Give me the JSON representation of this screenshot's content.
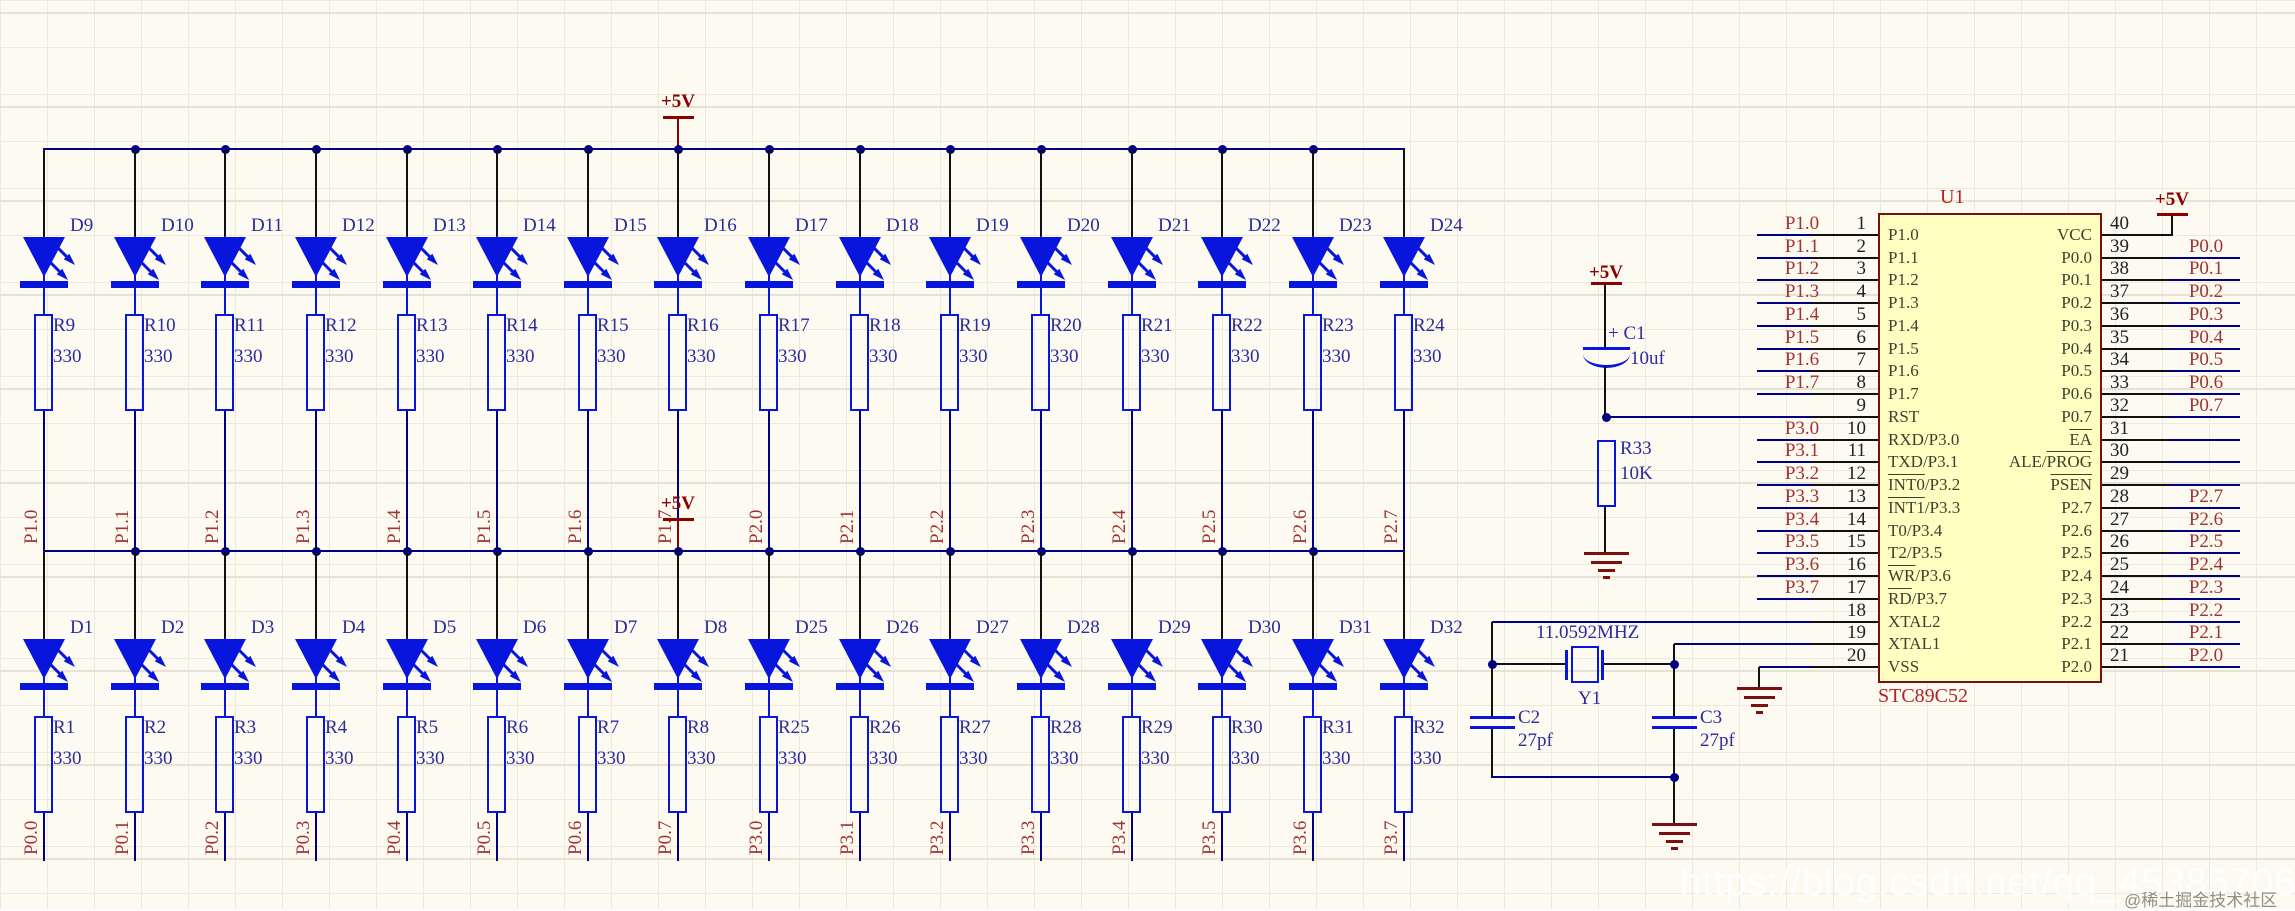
{
  "power": {
    "label": "+5V"
  },
  "colors": {
    "wire": "#000080",
    "symbol": "#0715dd",
    "net_label": "#a03333",
    "power": "#8b0000",
    "mcu_fill": "#ffffc2",
    "mcu_border": "#7a1010"
  },
  "top_row": {
    "leds": [
      "D9",
      "D10",
      "D11",
      "D12",
      "D13",
      "D14",
      "D15",
      "D16",
      "D17",
      "D18",
      "D19",
      "D20",
      "D21",
      "D22",
      "D23",
      "D24"
    ],
    "resistors": [
      "R9",
      "R10",
      "R11",
      "R12",
      "R13",
      "R14",
      "R15",
      "R16",
      "R17",
      "R18",
      "R19",
      "R20",
      "R21",
      "R22",
      "R23",
      "R24"
    ],
    "resistor_value": "330",
    "pins": [
      "P1.0",
      "P1.1",
      "P1.2",
      "P1.3",
      "P1.4",
      "P1.5",
      "P1.6",
      "P1.7",
      "P2.0",
      "P2.1",
      "P2.2",
      "P2.3",
      "P2.4",
      "P2.5",
      "P2.6",
      "P2.7"
    ]
  },
  "bottom_row": {
    "leds": [
      "D1",
      "D2",
      "D3",
      "D4",
      "D5",
      "D6",
      "D7",
      "D8",
      "D25",
      "D26",
      "D27",
      "D28",
      "D29",
      "D30",
      "D31",
      "D32"
    ],
    "resistors": [
      "R1",
      "R2",
      "R3",
      "R4",
      "R5",
      "R6",
      "R7",
      "R8",
      "R25",
      "R26",
      "R27",
      "R28",
      "R29",
      "R30",
      "R31",
      "R32"
    ],
    "resistor_value": "330",
    "pins": [
      "P0.0",
      "P0.1",
      "P0.2",
      "P0.3",
      "P0.4",
      "P0.5",
      "P0.6",
      "P0.7",
      "P3.0",
      "P3.1",
      "P3.2",
      "P3.3",
      "P3.4",
      "P3.5",
      "P3.6",
      "P3.7"
    ]
  },
  "reset_circuit": {
    "cap_label": "+ C1",
    "cap_value": "10uf",
    "res_ref": "R33",
    "res_value": "10K"
  },
  "crystal_circuit": {
    "freq": "11.0592MHZ",
    "ref": "Y1",
    "c2_ref": "C2",
    "c2_value": "27pf",
    "c3_ref": "C3",
    "c3_value": "27pf"
  },
  "mcu": {
    "ref": "U1",
    "part": "STC89C52",
    "left_pins": [
      {
        "num": "1",
        "label": "P1.0",
        "net": "P1.0"
      },
      {
        "num": "2",
        "label": "P1.1",
        "net": "P1.1"
      },
      {
        "num": "3",
        "label": "P1.2",
        "net": "P1.2"
      },
      {
        "num": "4",
        "label": "P1.3",
        "net": "P1.3"
      },
      {
        "num": "5",
        "label": "P1.4",
        "net": "P1.4"
      },
      {
        "num": "6",
        "label": "P1.5",
        "net": "P1.5"
      },
      {
        "num": "7",
        "label": "P1.6",
        "net": "P1.6"
      },
      {
        "num": "8",
        "label": "P1.7",
        "net": "P1.7"
      },
      {
        "num": "9",
        "label": "RST",
        "net": ""
      },
      {
        "num": "10",
        "label": "RXD/P3.0",
        "net": "P3.0"
      },
      {
        "num": "11",
        "label": "TXD/P3.1",
        "net": "P3.1"
      },
      {
        "num": "12",
        "label": "INT0/P3.2",
        "bar": "INT0",
        "net": "P3.2"
      },
      {
        "num": "13",
        "label": "INT1/P3.3",
        "bar": "INT1",
        "net": "P3.3"
      },
      {
        "num": "14",
        "label": "T0/P3.4",
        "net": "P3.4"
      },
      {
        "num": "15",
        "label": "T2/P3.5",
        "net": "P3.5"
      },
      {
        "num": "16",
        "label": "WR/P3.6",
        "bar": "WR",
        "net": "P3.6"
      },
      {
        "num": "17",
        "label": "RD/P3.7",
        "bar": "RD",
        "net": "P3.7"
      },
      {
        "num": "18",
        "label": "XTAL2",
        "net": ""
      },
      {
        "num": "19",
        "label": "XTAL1",
        "net": ""
      },
      {
        "num": "20",
        "label": "VSS",
        "net": ""
      }
    ],
    "right_pins": [
      {
        "num": "40",
        "label": "VCC",
        "net": ""
      },
      {
        "num": "39",
        "label": "P0.0",
        "net": "P0.0"
      },
      {
        "num": "38",
        "label": "P0.1",
        "net": "P0.1"
      },
      {
        "num": "37",
        "label": "P0.2",
        "net": "P0.2"
      },
      {
        "num": "36",
        "label": "P0.3",
        "net": "P0.3"
      },
      {
        "num": "35",
        "label": "P0.4",
        "net": "P0.4"
      },
      {
        "num": "34",
        "label": "P0.5",
        "net": "P0.5"
      },
      {
        "num": "33",
        "label": "P0.6",
        "net": "P0.6"
      },
      {
        "num": "32",
        "label": "P0.7",
        "net": "P0.7"
      },
      {
        "num": "31",
        "label": "EA",
        "bar": "EA",
        "net": ""
      },
      {
        "num": "30",
        "label": "ALE/PROG",
        "bar": "PROG",
        "net": ""
      },
      {
        "num": "29",
        "label": "PSEN",
        "bar": "PSEN",
        "net": ""
      },
      {
        "num": "28",
        "label": "P2.7",
        "net": "P2.7"
      },
      {
        "num": "27",
        "label": "P2.6",
        "net": "P2.6"
      },
      {
        "num": "26",
        "label": "P2.5",
        "net": "P2.5"
      },
      {
        "num": "25",
        "label": "P2.4",
        "net": "P2.4"
      },
      {
        "num": "24",
        "label": "P2.3",
        "net": "P2.3"
      },
      {
        "num": "23",
        "label": "P2.2",
        "net": "P2.2"
      },
      {
        "num": "22",
        "label": "P2.1",
        "net": "P2.1"
      },
      {
        "num": "21",
        "label": "P2.0",
        "net": "P2.0"
      }
    ]
  },
  "watermarks": {
    "url": "https://blog.csdn.net/qq_45385706",
    "badge": "@稀土掘金技术社区"
  }
}
